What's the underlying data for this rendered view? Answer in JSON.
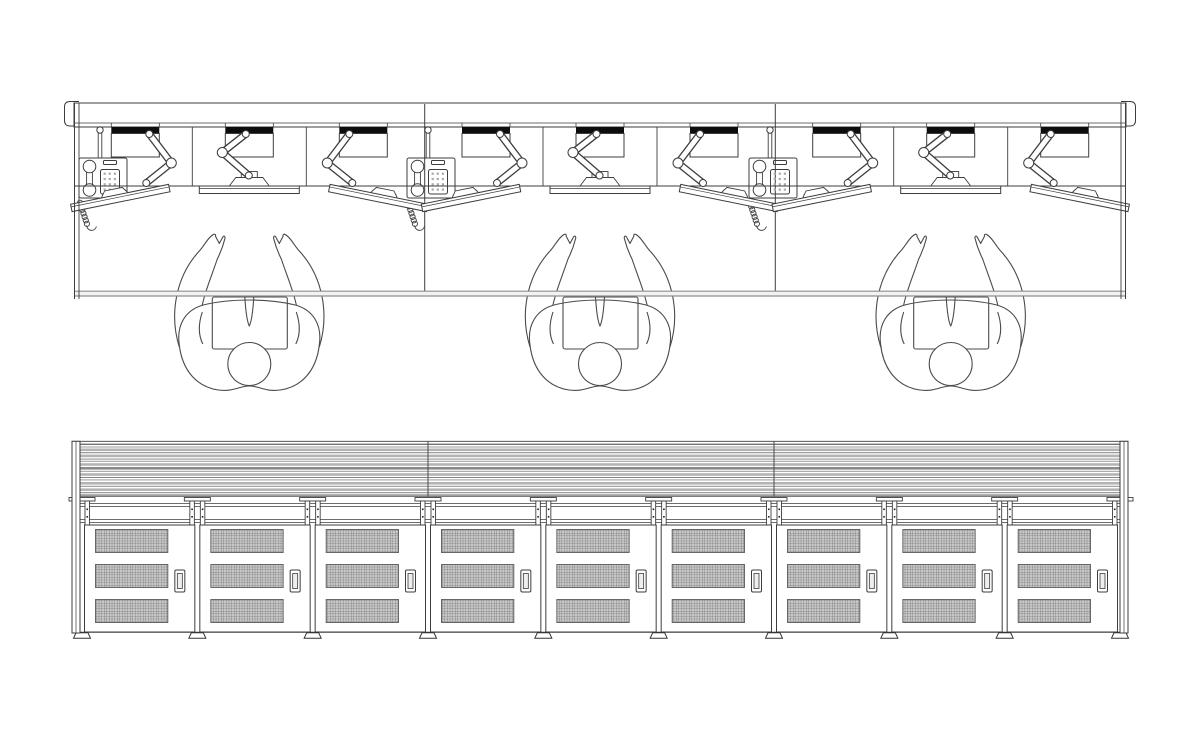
{
  "drawing": {
    "kind": "technical-cad-drawing",
    "subject": "control-room-console",
    "counts": {
      "workstation_modules": 3,
      "monitors_per_workstation": 3,
      "monitor_arms_per_workstation": 3,
      "telephones": 3,
      "operators": 3,
      "cabinet_doors": 9,
      "vent_grilles_per_door": 3,
      "door_handles": 9,
      "support_brackets": 10,
      "feet": 10
    },
    "colors": {
      "background": "#ffffff",
      "line": "#3d3d3d",
      "person_line": "#4a4a4a",
      "rail_black": "#0d0d0d",
      "desk_edge_fill": "#f2f2f2",
      "desk_edge_line": "#8f8f8f",
      "vent_fill": "#c9c9c9",
      "vent_grid": "#707070",
      "louver_dark": "#838383",
      "louver_light": "#b4b4b4"
    },
    "views": {
      "plan": {
        "left": 74,
        "right": 1126,
        "band": {
          "top": 103,
          "bottom": 127,
          "inner_line": 123
        },
        "module_centers": [
          249.3,
          600,
          950.7
        ],
        "divider_x": [
          424.7,
          775.3
        ],
        "station_offsets": [
          -114,
          0,
          114
        ],
        "substation_offsets": [
          -57,
          57
        ],
        "worktop_line_y": 186,
        "front_edge": {
          "top": 291.2,
          "bottom": 296
        },
        "rail_bar": {
          "half_w": 24,
          "top": 127,
          "bottom": 133.5
        },
        "housing_bottom": 157,
        "monitor": {
          "half_len": 50,
          "thickness": 7.5,
          "center_y": 186,
          "side_angle_deg": 11.5,
          "side_dx": 15,
          "side_cy": 198
        },
        "phones_x": [
          100,
          428,
          770
        ],
        "persons_x": [
          249.3,
          600,
          950.7
        ],
        "person_top_y": 233
      },
      "elevation": {
        "left": 72,
        "right": 1128,
        "top_line_y": 441.3,
        "end_strip_w": 8,
        "bottom_y": 633,
        "louver": {
          "x0": 80,
          "x1": 1120,
          "top": 444,
          "bottom": 496.5,
          "divider_x": [
            428,
            774
          ],
          "stripes": [
            [
              0,
              1,
              "#7d7d7d"
            ],
            [
              2.5,
              1,
              "#9b9b9b"
            ],
            [
              4.5,
              2.6,
              "#b4b4b4"
            ],
            [
              8.2,
              1,
              "#838383"
            ],
            [
              10.6,
              2.6,
              "#b4b4b4"
            ],
            [
              14.6,
              1,
              "#8d8d8d"
            ],
            [
              16.8,
              1,
              "#9b9b9b"
            ],
            [
              19.2,
              2.6,
              "#b4b4b4"
            ],
            [
              23,
              2.6,
              "#8a8a8a"
            ],
            [
              26.8,
              1,
              "#9b9b9b"
            ],
            [
              29.2,
              2.6,
              "#b4b4b4"
            ],
            [
              33,
              1,
              "#838383"
            ],
            [
              35.4,
              1,
              "#9b9b9b"
            ],
            [
              38,
              2.6,
              "#b4b4b4"
            ],
            [
              41.8,
              1,
              "#8d8d8d"
            ],
            [
              44.4,
              2.6,
              "#b4b4b4"
            ],
            [
              48.2,
              1,
              "#838383"
            ],
            [
              50.2,
              2.4,
              "#a0a0a0"
            ]
          ]
        },
        "rail_lines_y": [
          503.5,
          506.5,
          519.5,
          522.5
        ],
        "bracket": {
          "cap_half_w": 13,
          "cap_top": 497.5,
          "cap_h": 3.5,
          "post_top": 501,
          "post_bottom": 525,
          "post_inner": 3,
          "post_w": 4.5,
          "screw_y": [
            508.5,
            516
          ]
        },
        "doors": {
          "count": 9,
          "span_x0": 82,
          "span_x1": 1120,
          "top": 525,
          "bottom": 632,
          "edge_inset": 2.5,
          "vent": {
            "left_inset": 11,
            "right_inset": 27,
            "rows_y": [
              529.5,
              564.5,
              599.5
            ],
            "height": 23
          },
          "handle": {
            "right_inset": 20,
            "width": 10,
            "top": 570,
            "height": 22
          }
        },
        "base_line_y": 632.3,
        "foot": {
          "top_half_w": 6,
          "bottom_half_w": 8.5,
          "height": 5.4
        }
      }
    }
  }
}
